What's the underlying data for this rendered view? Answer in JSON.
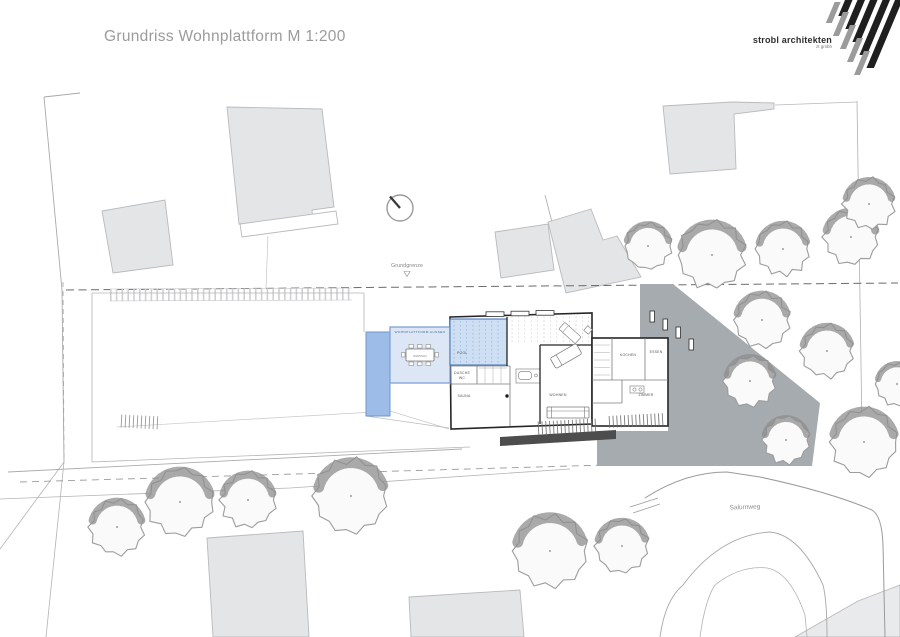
{
  "title": "Grundriss Wohnplattform M 1:200",
  "logo": {
    "name": "strobl architekten",
    "sub": "zt gmbh"
  },
  "plan": {
    "boundary_label": "Grundgrenze",
    "street_label": "Salurnweg",
    "rooms": {
      "terrace_header": "WOHNPLATTFORM AUSSEN",
      "table": "ESSTISCH",
      "pool": "POOL",
      "shower": "DUSCHE",
      "wc": "WC",
      "spa": "SAUNA",
      "living": "WOHNEN",
      "kitchen": "KOCHEN",
      "dining": "ESSEN",
      "bedroom": "ZIMMER"
    },
    "north_symbol": "north-arrow",
    "trees": [
      [
        648,
        246,
        23
      ],
      [
        712,
        255,
        33
      ],
      [
        783,
        249,
        26
      ],
      [
        851,
        237,
        27
      ],
      [
        869,
        204,
        25
      ],
      [
        762,
        320,
        27
      ],
      [
        827,
        351,
        26
      ],
      [
        750,
        381,
        25
      ],
      [
        786,
        440,
        23
      ],
      [
        864,
        442,
        33
      ],
      [
        897,
        384,
        21
      ],
      [
        117,
        527,
        27
      ],
      [
        180,
        502,
        33
      ],
      [
        248,
        500,
        27
      ],
      [
        351,
        496,
        36
      ],
      [
        550,
        551,
        36
      ],
      [
        622,
        546,
        26
      ]
    ],
    "buildings": [
      {
        "points": [
          [
            102,
            211
          ],
          [
            165,
            200
          ],
          [
            173,
            265
          ],
          [
            113,
            273
          ]
        ],
        "fill": "#e4e5e7"
      },
      {
        "points": [
          [
            227,
            107
          ],
          [
            322,
            109
          ],
          [
            334,
            207
          ],
          [
            312,
            210
          ],
          [
            313,
            222
          ],
          [
            239,
            224
          ]
        ],
        "fill": "#e4e5e7"
      },
      {
        "points": [
          [
            240,
            224
          ],
          [
            336,
            211
          ],
          [
            338,
            224
          ],
          [
            242,
            237
          ]
        ],
        "fill": "#ffffff"
      },
      {
        "points": [
          [
            495,
            232
          ],
          [
            548,
            224
          ],
          [
            554,
            270
          ],
          [
            501,
            278
          ]
        ],
        "fill": "#e4e5e7"
      },
      {
        "points": [
          [
            548,
            222
          ],
          [
            591,
            209
          ],
          [
            603,
            240
          ],
          [
            617,
            236
          ],
          [
            641,
            277
          ],
          [
            566,
            293
          ]
        ],
        "fill": "#e4e5e7"
      },
      {
        "points": [
          [
            663,
            106
          ],
          [
            732,
            102
          ],
          [
            774,
            103
          ],
          [
            774,
            109
          ],
          [
            734,
            114
          ],
          [
            736,
            169
          ],
          [
            670,
            174
          ]
        ],
        "fill": "#e4e5e7"
      },
      {
        "points": [
          [
            207,
            538
          ],
          [
            303,
            531
          ],
          [
            309,
            637
          ],
          [
            213,
            637
          ]
        ],
        "fill": "#e4e5e7"
      },
      {
        "points": [
          [
            409,
            597
          ],
          [
            520,
            590
          ],
          [
            524,
            637
          ],
          [
            411,
            637
          ]
        ],
        "fill": "#e4e5e7"
      },
      {
        "points": [
          [
            795,
            637
          ],
          [
            858,
            601
          ],
          [
            900,
            585
          ],
          [
            900,
            637
          ]
        ],
        "fill": "#e9eaec"
      }
    ]
  },
  "colors": {
    "building_stroke": "#b9babd",
    "tree_fill": "#fafafa",
    "tree_stroke": "#9c9c9c",
    "tree_shade": "#8e8e8e",
    "driveway": "#a6abb0",
    "pool_water": "#9dbde8",
    "pool_room": "#cfdff3",
    "terrace": "#dce6f5",
    "pool_border": "#6d96cc",
    "wall": "#262626",
    "logo_black": "#1f1f1f",
    "logo_gray": "#9b9b9b"
  }
}
